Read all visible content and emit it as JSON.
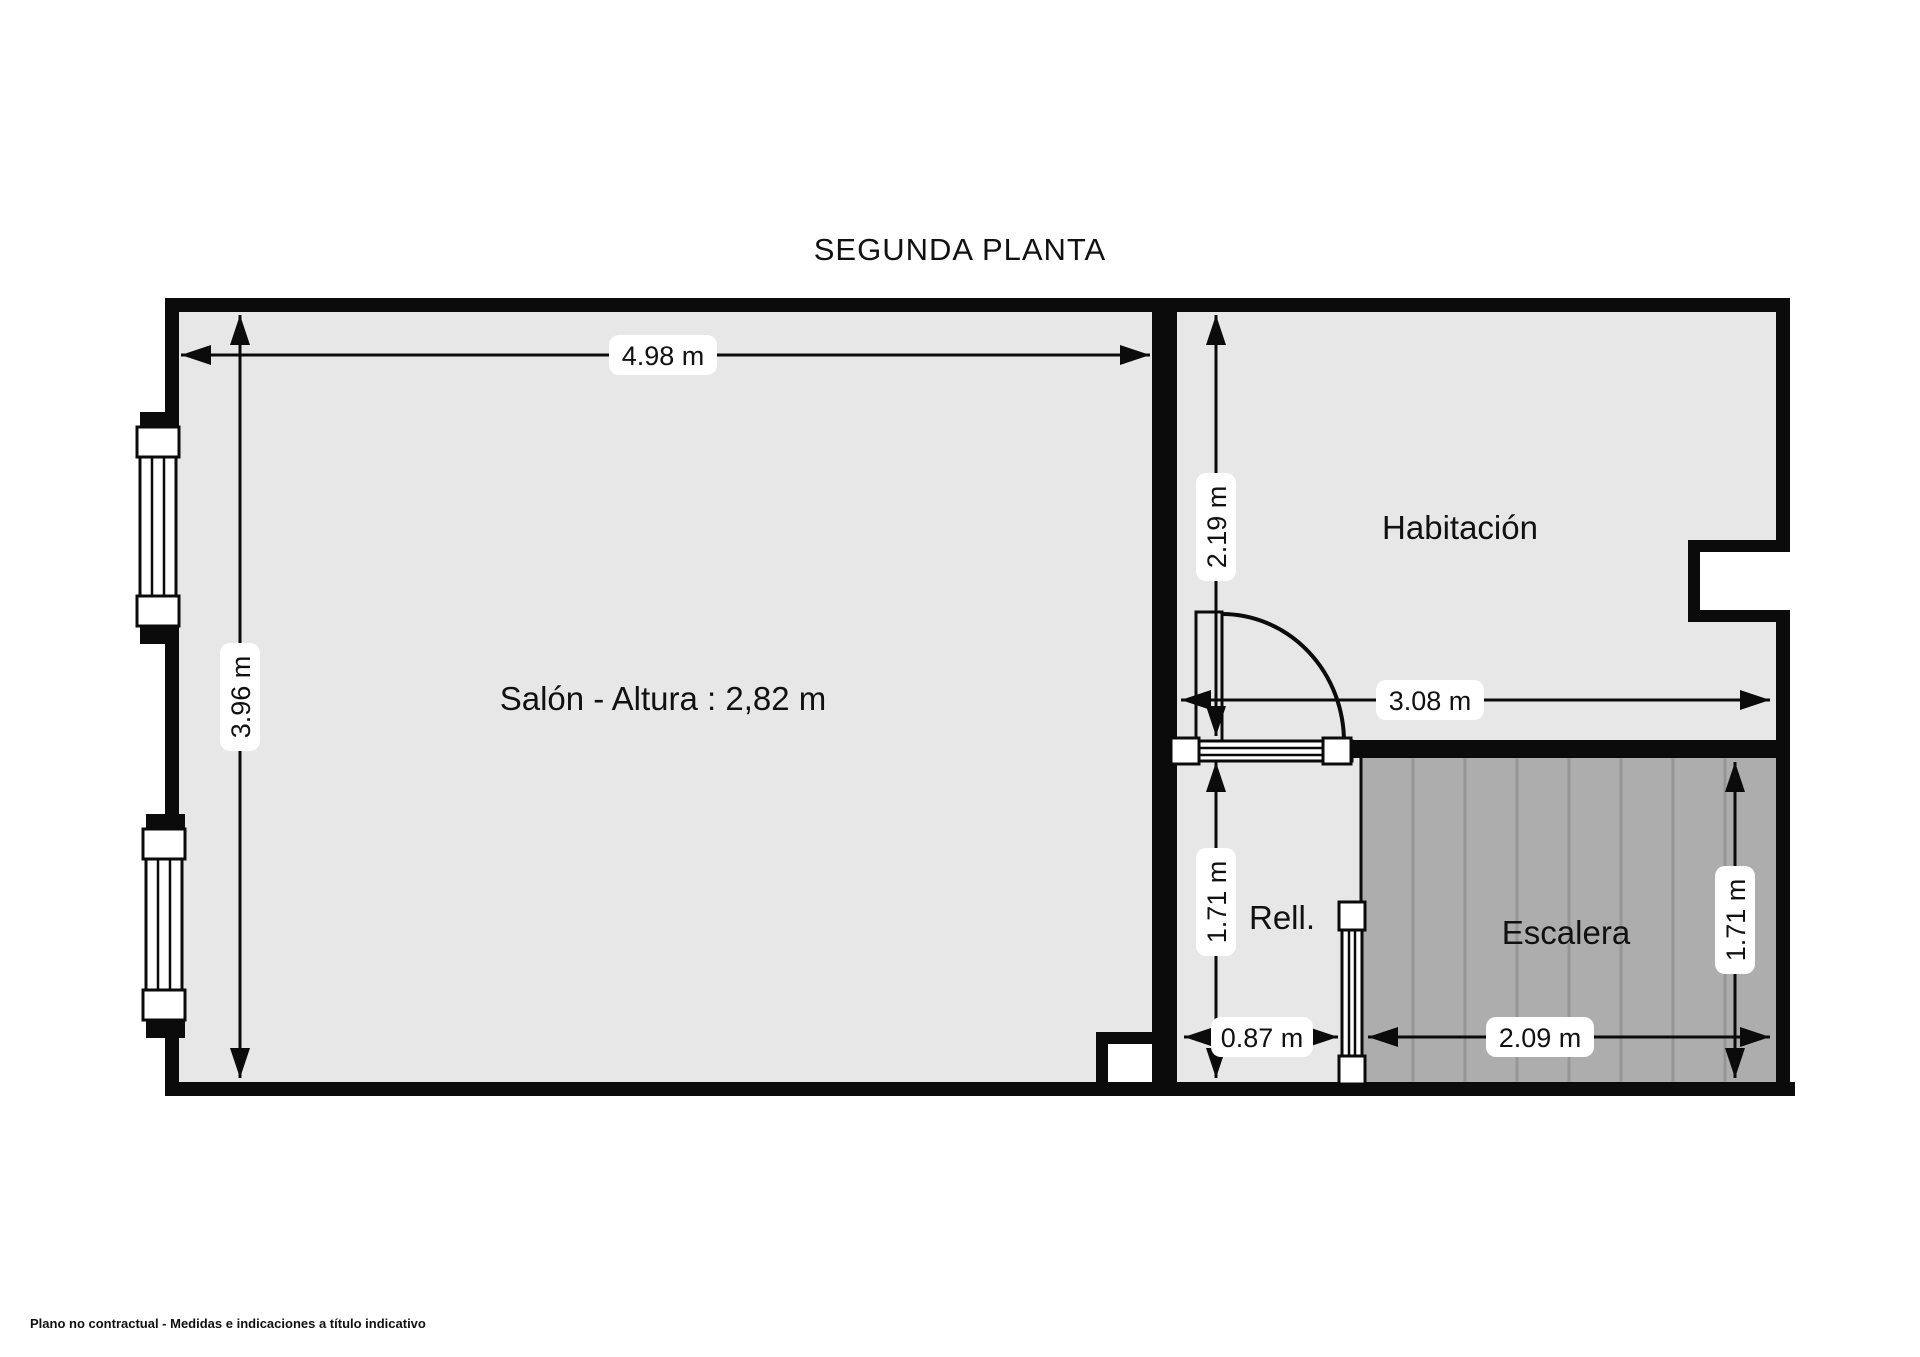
{
  "title": "SEGUNDA PLANTA",
  "rooms": {
    "salon": {
      "label": "Salón - Altura : 2,82 m"
    },
    "habitacion": {
      "label": "Habitación"
    },
    "rellano": {
      "label": "Rell."
    },
    "escalera": {
      "label": "Escalera"
    }
  },
  "dimensions": {
    "salon_width": "4.98 m",
    "salon_depth": "3.96 m",
    "habitacion_depth": "2.19 m",
    "habitacion_width": "3.08 m",
    "rellano_depth": "1.71 m",
    "rellano_width": "0.87 m",
    "escalera_width": "2.09 m",
    "escalera_depth": "1.71 m"
  },
  "footer": "Plano no contractual - Medidas e indicaciones a título indicativo",
  "colors": {
    "floor": "#e7e7e7",
    "stairs_floor": "#adadad",
    "walls": "#0b0b0b",
    "dimension_pill": "#ffffff",
    "text": "#111111"
  }
}
